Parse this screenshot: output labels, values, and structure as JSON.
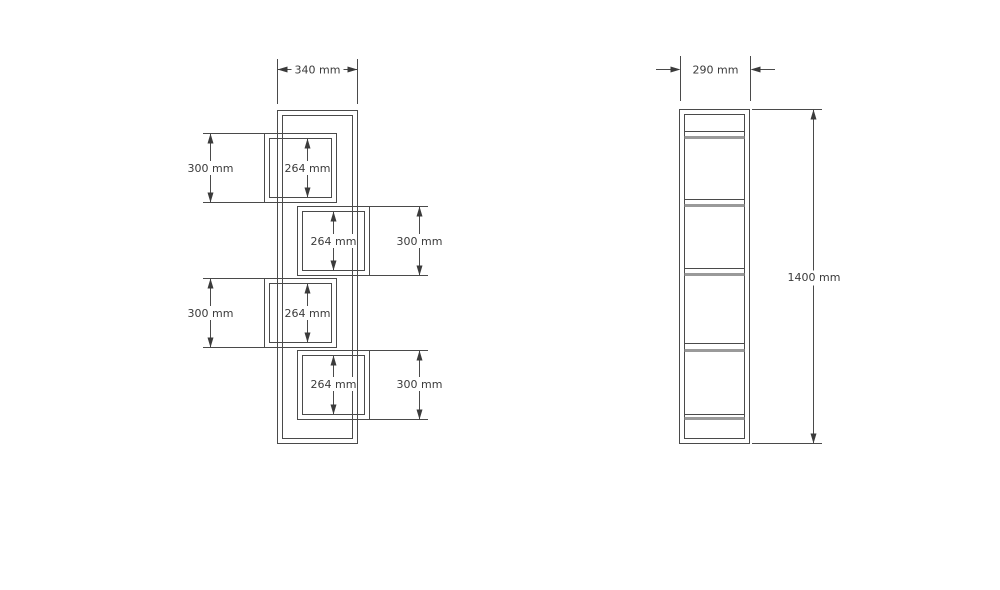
{
  "drawing": {
    "front_view": {
      "width_label": "340 mm",
      "left_height_labels": [
        "300 mm",
        "300 mm"
      ],
      "right_height_labels": [
        "300 mm",
        "300 mm"
      ],
      "compartment_labels": [
        "264 mm",
        "264 mm",
        "264 mm",
        "264 mm"
      ]
    },
    "side_view": {
      "width_label": "290 mm",
      "height_label": "1400 mm"
    },
    "colors": {
      "line": "#4a4a4a",
      "shelf_accent": "#9a9a9a",
      "text": "#3b3b3b",
      "background": "#ffffff"
    }
  }
}
